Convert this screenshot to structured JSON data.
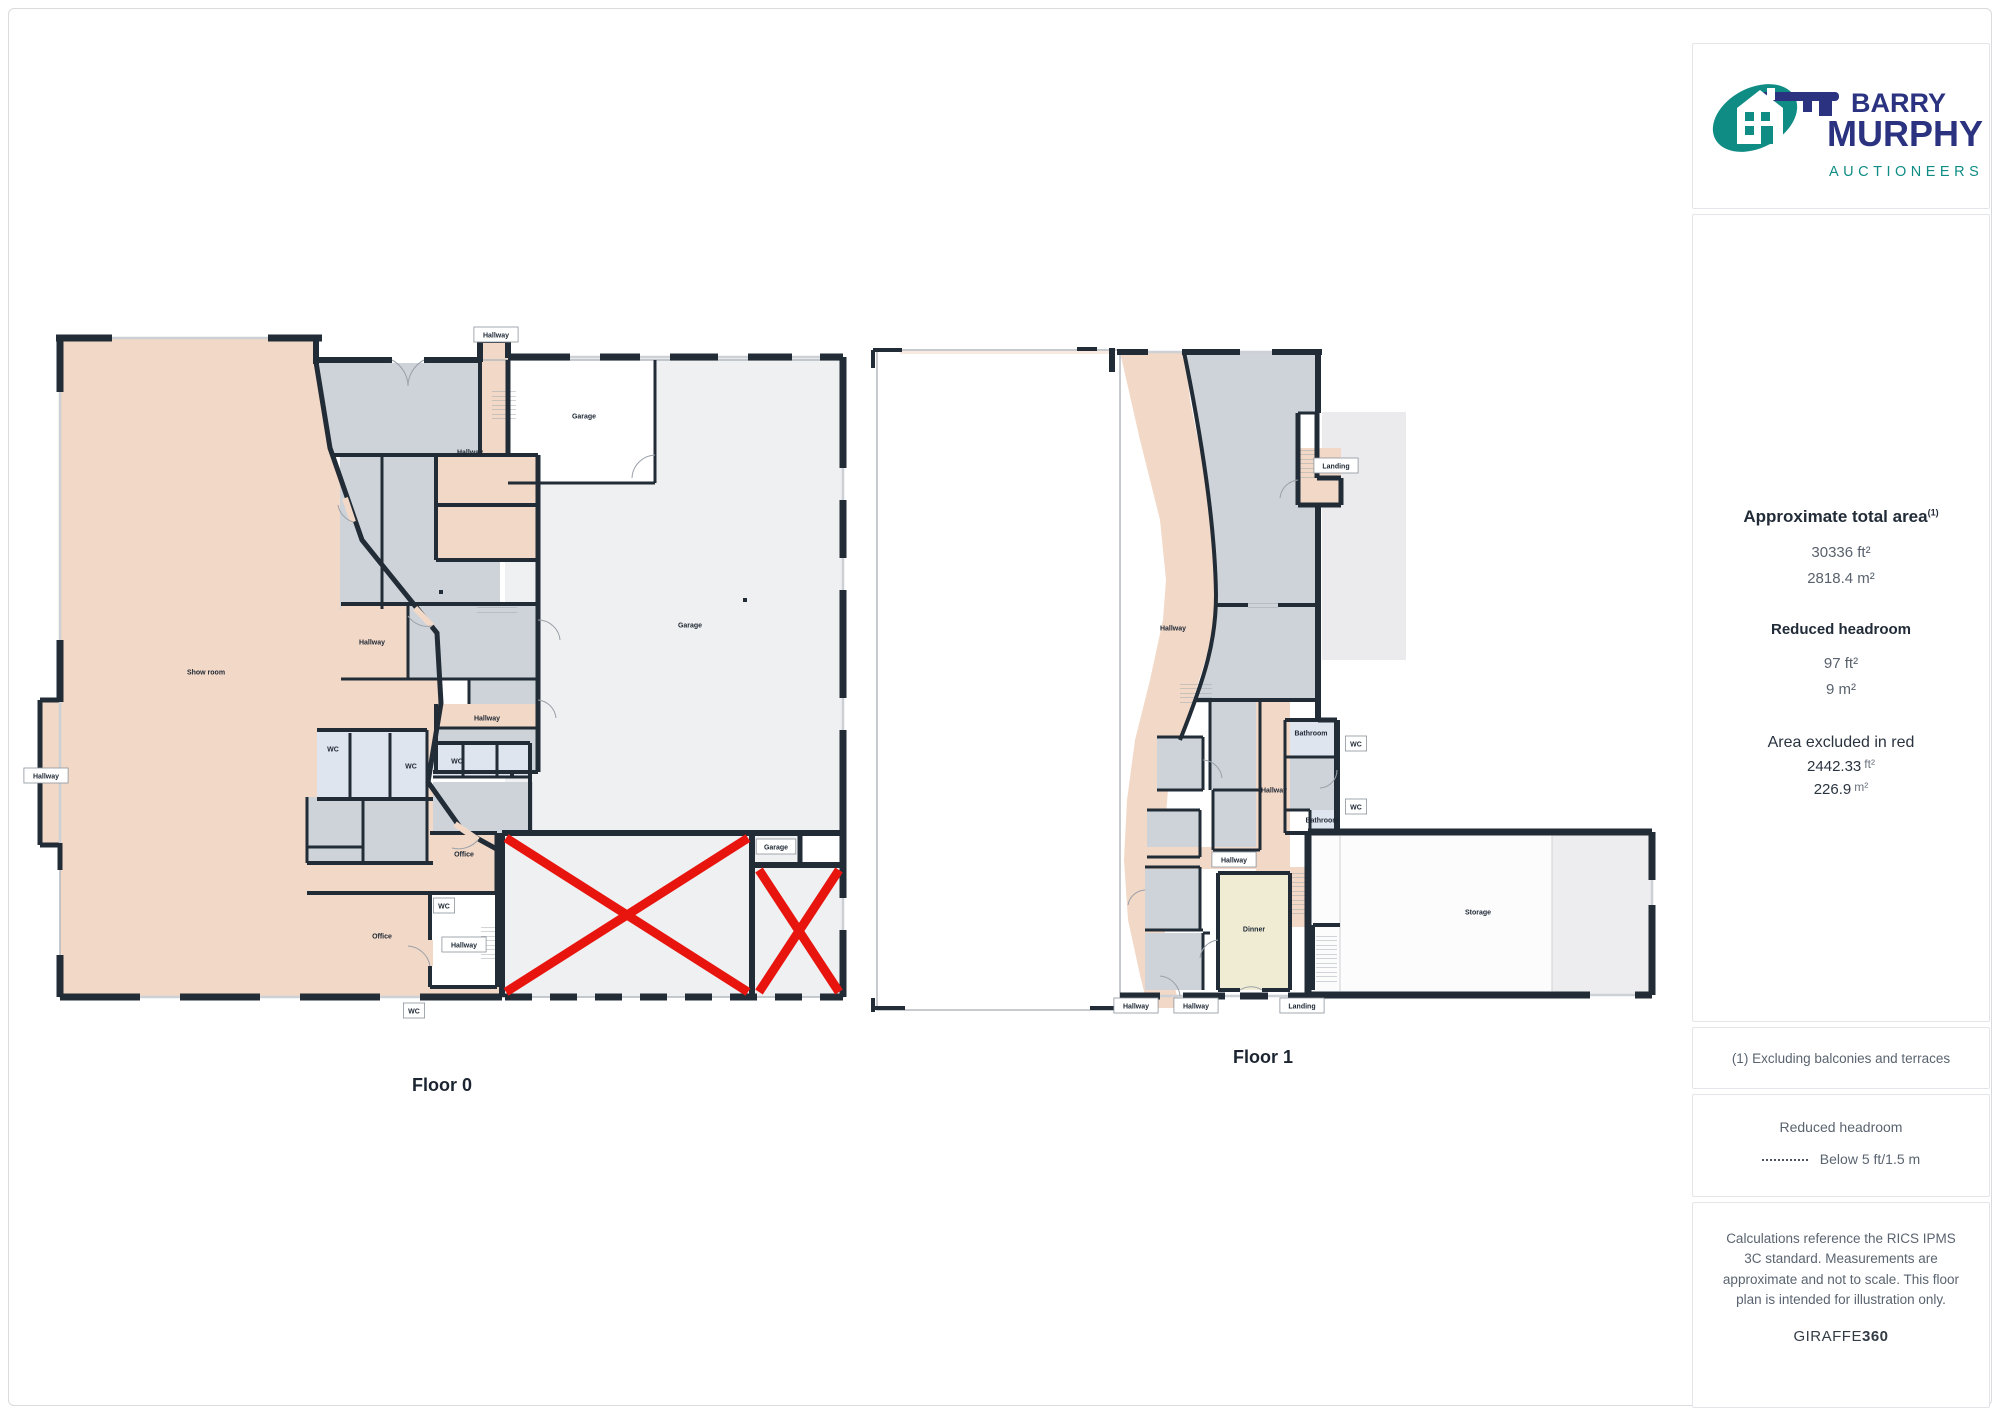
{
  "logo": {
    "line1": "BARRY",
    "line2": "MURPHY",
    "line3": "AUCTIONEERS",
    "navy": "#2b3280",
    "teal": "#0f8d85"
  },
  "sidebar": {
    "approx_title": "Approximate total area",
    "approx_footnote_mark": "(1)",
    "approx_ft": "30336 ft²",
    "approx_m": "2818.4 m²",
    "reduced_title": "Reduced headroom",
    "reduced_ft": "97 ft²",
    "reduced_m": "9 m²",
    "excluded_title": "Area excluded in red",
    "excluded_ft_value": "2442.33",
    "excluded_ft_unit": "ft²",
    "excluded_m_value": "226.9",
    "excluded_m_unit": "m²",
    "note": "(1) Excluding balconies and terraces",
    "legend_title": "Reduced headroom",
    "legend_label": "Below 5 ft/1.5 m",
    "disclaimer": "Calculations reference the RICS IPMS 3C standard. Measurements are approximate and not to scale. This floor plan is intended for illustration only.",
    "brand_name": "GIRAFFE",
    "brand_number": "360"
  },
  "floors": {
    "floor0": {
      "label": "Floor 0",
      "labels": [
        {
          "text": "Show room",
          "x": 206,
          "y": 672,
          "kind": "room"
        },
        {
          "text": "Garage",
          "x": 584,
          "y": 416,
          "kind": "room"
        },
        {
          "text": "Garage",
          "x": 690,
          "y": 625,
          "kind": "room"
        },
        {
          "text": "Hallway",
          "x": 372,
          "y": 642,
          "kind": "room"
        },
        {
          "text": "Hallway",
          "x": 470,
          "y": 452,
          "kind": "room"
        },
        {
          "text": "Hallway",
          "x": 487,
          "y": 718,
          "kind": "room"
        },
        {
          "text": "WC",
          "x": 333,
          "y": 749,
          "kind": "room"
        },
        {
          "text": "WC",
          "x": 411,
          "y": 766,
          "kind": "room"
        },
        {
          "text": "WC",
          "x": 457,
          "y": 761,
          "kind": "room"
        },
        {
          "text": "Office",
          "x": 464,
          "y": 854,
          "kind": "room"
        },
        {
          "text": "Office",
          "x": 382,
          "y": 936,
          "kind": "room"
        },
        {
          "text": "Hallway",
          "x": 496,
          "y": 335,
          "kind": "box"
        },
        {
          "text": "Hallway",
          "x": 46,
          "y": 776,
          "kind": "box"
        },
        {
          "text": "WC",
          "x": 444,
          "y": 906,
          "kind": "box"
        },
        {
          "text": "Hallway",
          "x": 464,
          "y": 945,
          "kind": "box"
        },
        {
          "text": "Garage",
          "x": 776,
          "y": 847,
          "kind": "box"
        },
        {
          "text": "WC",
          "x": 414,
          "y": 1011,
          "kind": "box"
        }
      ]
    },
    "floor1": {
      "label": "Floor 1",
      "labels": [
        {
          "text": "Hallway",
          "x": 1173,
          "y": 628,
          "kind": "room"
        },
        {
          "text": "Bathroom",
          "x": 1311,
          "y": 733,
          "kind": "room"
        },
        {
          "text": "Bathroom",
          "x": 1322,
          "y": 820,
          "kind": "room"
        },
        {
          "text": "Dinner",
          "x": 1254,
          "y": 929,
          "kind": "room"
        },
        {
          "text": "Storage",
          "x": 1478,
          "y": 912,
          "kind": "room"
        },
        {
          "text": "Hallway",
          "x": 1274,
          "y": 790,
          "kind": "room"
        },
        {
          "text": "Landing",
          "x": 1336,
          "y": 466,
          "kind": "box"
        },
        {
          "text": "WC",
          "x": 1356,
          "y": 744,
          "kind": "box"
        },
        {
          "text": "WC",
          "x": 1356,
          "y": 807,
          "kind": "box"
        },
        {
          "text": "Hallway",
          "x": 1136,
          "y": 1006,
          "kind": "box"
        },
        {
          "text": "Hallway",
          "x": 1196,
          "y": 1006,
          "kind": "box"
        },
        {
          "text": "Hallway",
          "x": 1234,
          "y": 860,
          "kind": "box"
        },
        {
          "text": "Landing",
          "x": 1302,
          "y": 1006,
          "kind": "box"
        }
      ]
    }
  },
  "colors": {
    "wall": "#212c37",
    "pink": "#f2d8c7",
    "gray": "#ced3d9",
    "lightgray": "#eff0f2",
    "blue": "#dfe5ef",
    "cream": "#f0ecd4",
    "red": "#e8140e"
  }
}
